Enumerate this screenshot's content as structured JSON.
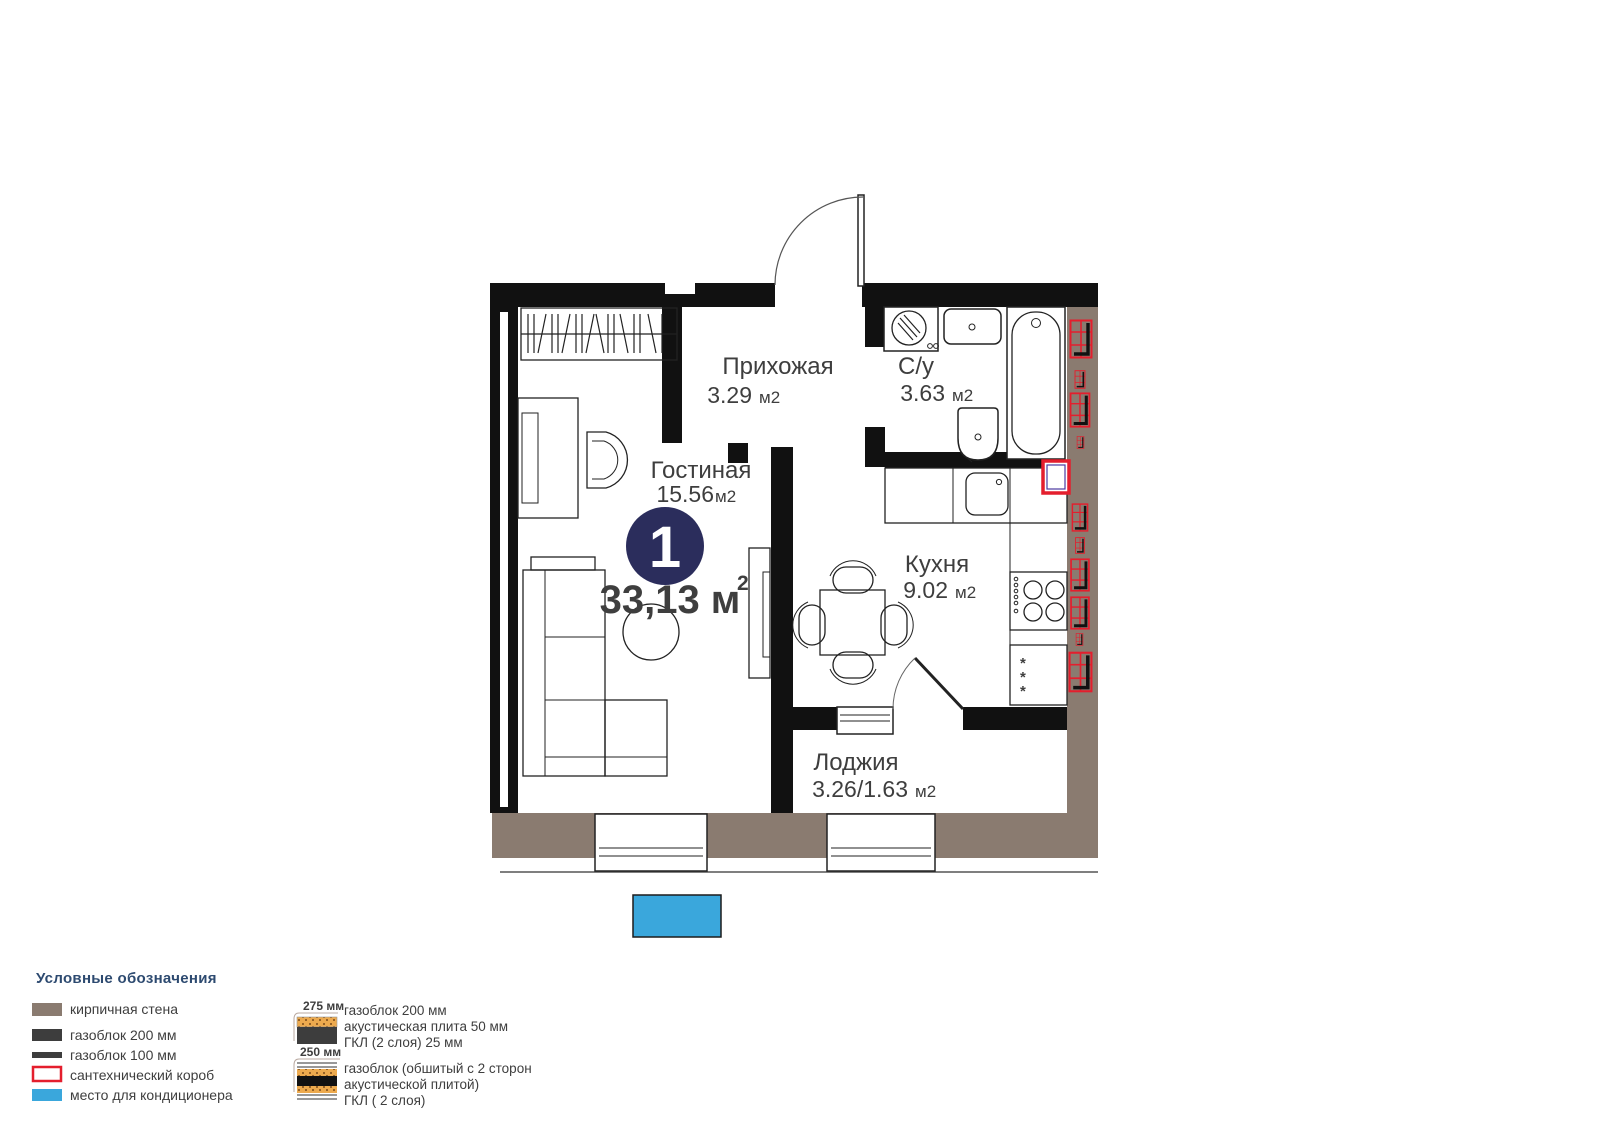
{
  "plan": {
    "unit_badge": "1",
    "total_area": "33,13 м",
    "total_area_sup": "2",
    "rooms": {
      "living": {
        "name": "Гостиная",
        "area_value": "15.56",
        "area_unit": "м2"
      },
      "hallway": {
        "name": "Прихожая",
        "area_value": "3.29",
        "area_unit": "м2"
      },
      "bathroom": {
        "name": "С/у",
        "area_value": "3.63",
        "area_unit": "м2"
      },
      "kitchen": {
        "name": "Кухня",
        "area_value": "9.02",
        "area_unit": "м2"
      },
      "loggia": {
        "name": "Лоджия",
        "area_value": "3.26/1.63",
        "area_unit": "м2"
      }
    },
    "fridge_mark": "*"
  },
  "legend": {
    "title": "Условные обозначения",
    "items": [
      {
        "label": "кирпичная стена"
      },
      {
        "label": "газоблок 200 мм"
      },
      {
        "label": "газоблок 100 мм"
      },
      {
        "label": "сантехнический короб"
      },
      {
        "label": "место для кондиционера"
      }
    ],
    "wall_types": [
      {
        "dimension": "275 мм",
        "lines": [
          "газоблок 200 мм",
          "акустическая плита 50 мм",
          "ГКЛ (2 слоя) 25 мм"
        ]
      },
      {
        "dimension": "250 мм",
        "lines": [
          "газоблок (обшитый с 2 сторон",
          "акустической плитой)",
          "ГКЛ ( 2 слоя)"
        ]
      }
    ]
  },
  "colors": {
    "brick": "#8a7b70",
    "gasblock": "#3d3d3d",
    "plumbing_red": "#e41e2d",
    "ac_blue": "#3aa7dc",
    "badge_navy": "#2b2d5c",
    "text": "#3e3e3e",
    "legend_title": "#2d4a70"
  }
}
